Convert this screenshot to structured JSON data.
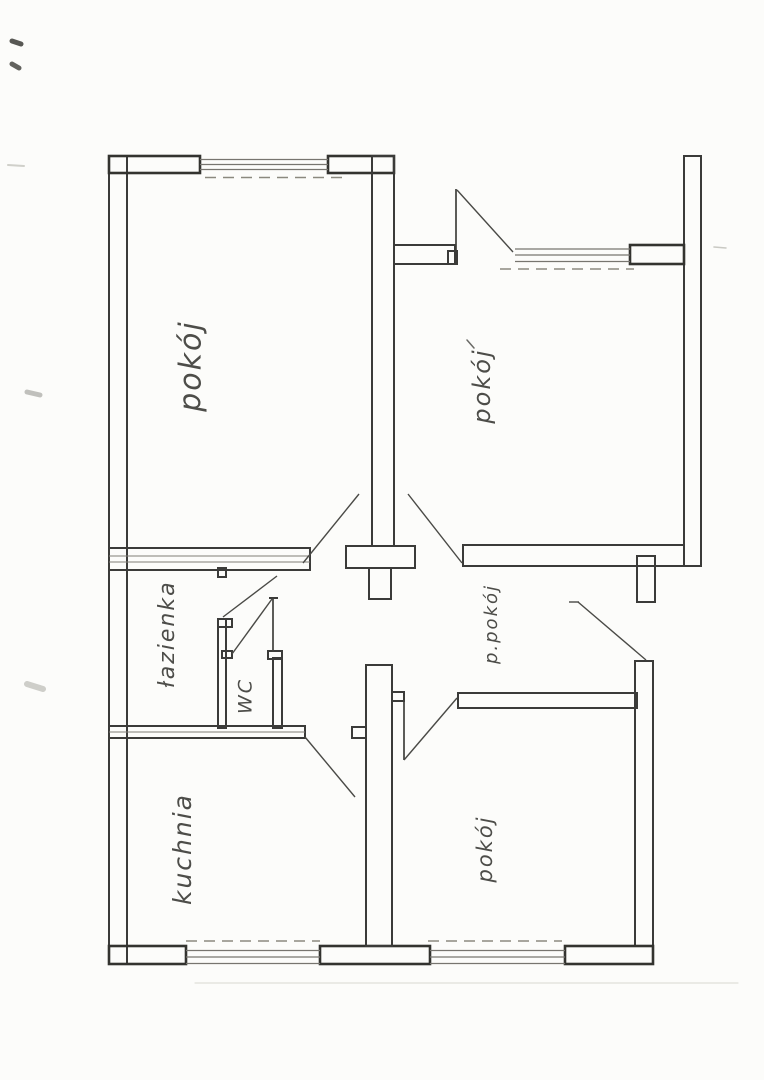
{
  "page": {
    "paper_color": "#fcfcfa",
    "ink_color": "#3b3b39",
    "pencil_color": "#4d4d49"
  },
  "floorplan": {
    "rooms": [
      {
        "id": "room-top-left",
        "label": "pokój"
      },
      {
        "id": "room-top-right",
        "label": "pokój"
      },
      {
        "id": "hallway",
        "label": "p.pokój"
      },
      {
        "id": "bathroom",
        "label": "łazienka"
      },
      {
        "id": "wc",
        "label": "WC"
      },
      {
        "id": "kitchen",
        "label": "kuchnia"
      },
      {
        "id": "room-bottom-right",
        "label": "pokój"
      }
    ]
  }
}
